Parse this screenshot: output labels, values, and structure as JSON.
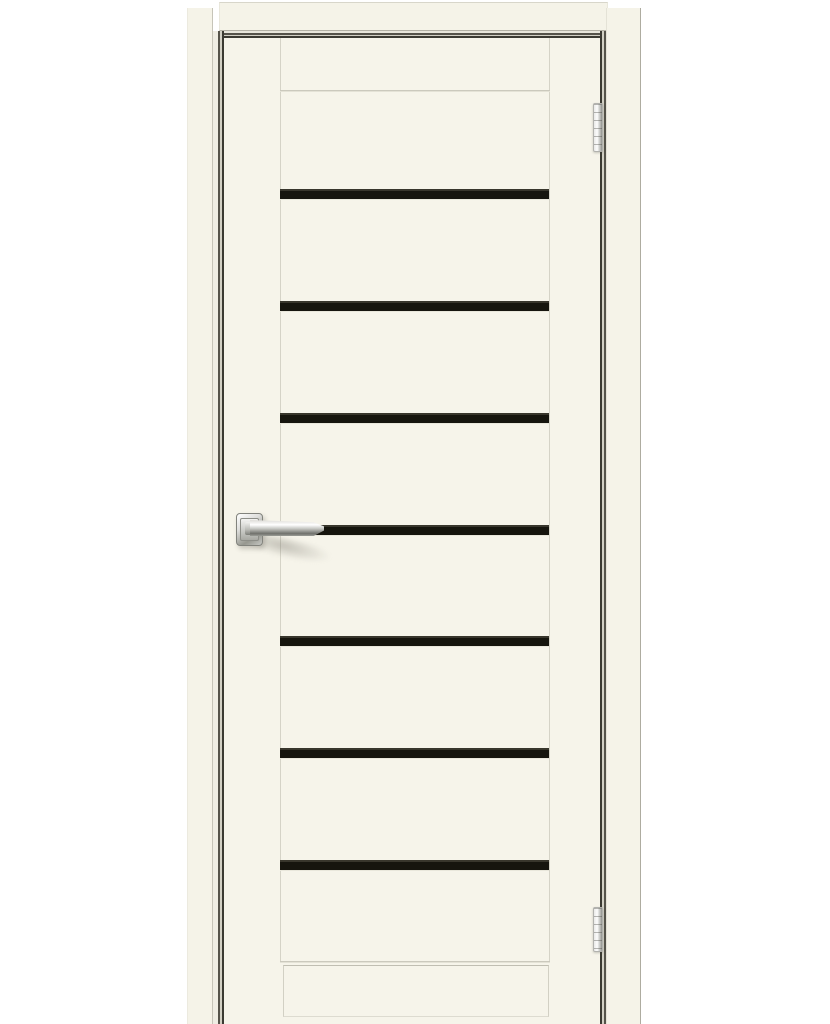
{
  "page": {
    "type": "product-photo",
    "subject": "White interior door with seven horizontal black glass inserts, polished chrome lever handle and two chrome hinges on the right side",
    "background_color": "#ffffff"
  },
  "door": {
    "leaf_color": "#f6f4ea",
    "casing_color": "#f5f3e8",
    "panel_line_color": "#d5d3c7",
    "gap_dark_color": "#3b3a32",
    "glass": {
      "stripe_count": 7,
      "stripe_color": "#16150e",
      "stripe_x": 280,
      "stripe_width": 269,
      "stripe_height": 10,
      "stripe_y_positions": [
        189,
        301,
        413,
        525,
        636,
        748,
        860
      ]
    },
    "handle": {
      "style": "lever-on-square-rosette",
      "finish": "polished-chrome",
      "x": 236,
      "y": 513
    },
    "hinges": {
      "finish": "polished-chrome",
      "positions": [
        {
          "y": 103,
          "height": 49
        },
        {
          "y": 907,
          "height": 45
        }
      ]
    }
  }
}
